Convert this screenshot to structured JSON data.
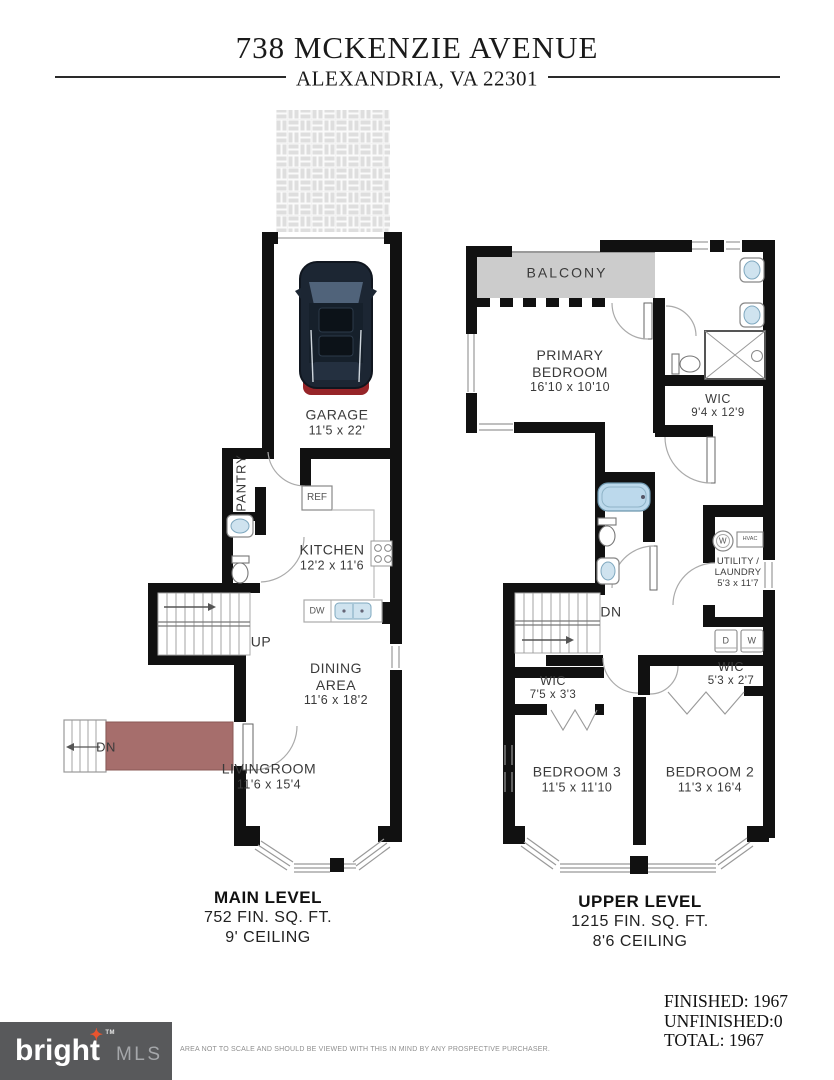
{
  "header": {
    "title": "738 MCKENZIE AVENUE",
    "subtitle": "ALEXANDRIA, VA 22301"
  },
  "main_level": {
    "rooms": {
      "garage": {
        "name": "GARAGE",
        "dims": "11'5 x 22'"
      },
      "pantry": {
        "name": "PANTRY"
      },
      "kitchen": {
        "name": "KITCHEN",
        "dims": "12'2 x 11'6"
      },
      "dining": {
        "line1": "DINING",
        "line2": "AREA",
        "dims": "11'6 x 18'2"
      },
      "living": {
        "name": "LIVINGROOM",
        "dims": "11'6 x 15'4"
      }
    },
    "labels": {
      "up": "UP",
      "down": "DN",
      "ref": "REF",
      "dw": "DW"
    },
    "caption": {
      "title": "MAIN LEVEL",
      "area": "752 FIN. SQ. FT.",
      "ceiling": "9' CEILING"
    }
  },
  "upper_level": {
    "rooms": {
      "balcony": {
        "name": "BALCONY"
      },
      "primary": {
        "line1": "PRIMARY",
        "line2": "BEDROOM",
        "dims": "16'10 x 10'10"
      },
      "wic_primary": {
        "name": "WIC",
        "dims": "9'4 x 12'9"
      },
      "utility": {
        "line1": "UTILITY /",
        "line2": "LAUNDRY",
        "dims": "5'3 x 11'7"
      },
      "wic_hall": {
        "name": "WIC",
        "dims": "5'3 x 2'7"
      },
      "wic_bedroom3": {
        "name": "WIC",
        "dims": "7'5 x 3'3"
      },
      "bedroom3": {
        "name": "BEDROOM 3",
        "dims": "11'5 x 11'10"
      },
      "bedroom2": {
        "name": "BEDROOM 2",
        "dims": "11'3 x 16'4"
      }
    },
    "labels": {
      "down": "DN",
      "washer": "W",
      "hvac": "HVAC",
      "dryer": "D",
      "washer2": "W"
    },
    "caption": {
      "title": "UPPER LEVEL",
      "area": "1215 FIN. SQ. FT.",
      "ceiling": "8'6 CEILING"
    }
  },
  "footer": {
    "logo": {
      "brand": "bright",
      "star_icon": "✦",
      "tm": "TM",
      "suffix": "MLS"
    },
    "disclaimer": "AREA NOT TO SCALE AND SHOULD BE VIEWED WITH THIS IN MIND BY ANY PROSPECTIVE PURCHASER.",
    "totals": {
      "finished": "FINISHED: 1967",
      "unfinished": "UNFINISHED:0",
      "total": "TOTAL: 1967"
    }
  },
  "colors": {
    "wall": "#111111",
    "balcony_fill": "#cccccc",
    "porch_fill": "#a66e6c",
    "fixture_blue": "#cfe3ef",
    "logo_bg": "#58595b",
    "logo_star": "#e8542e",
    "logo_mls": "#a5a7aa"
  }
}
